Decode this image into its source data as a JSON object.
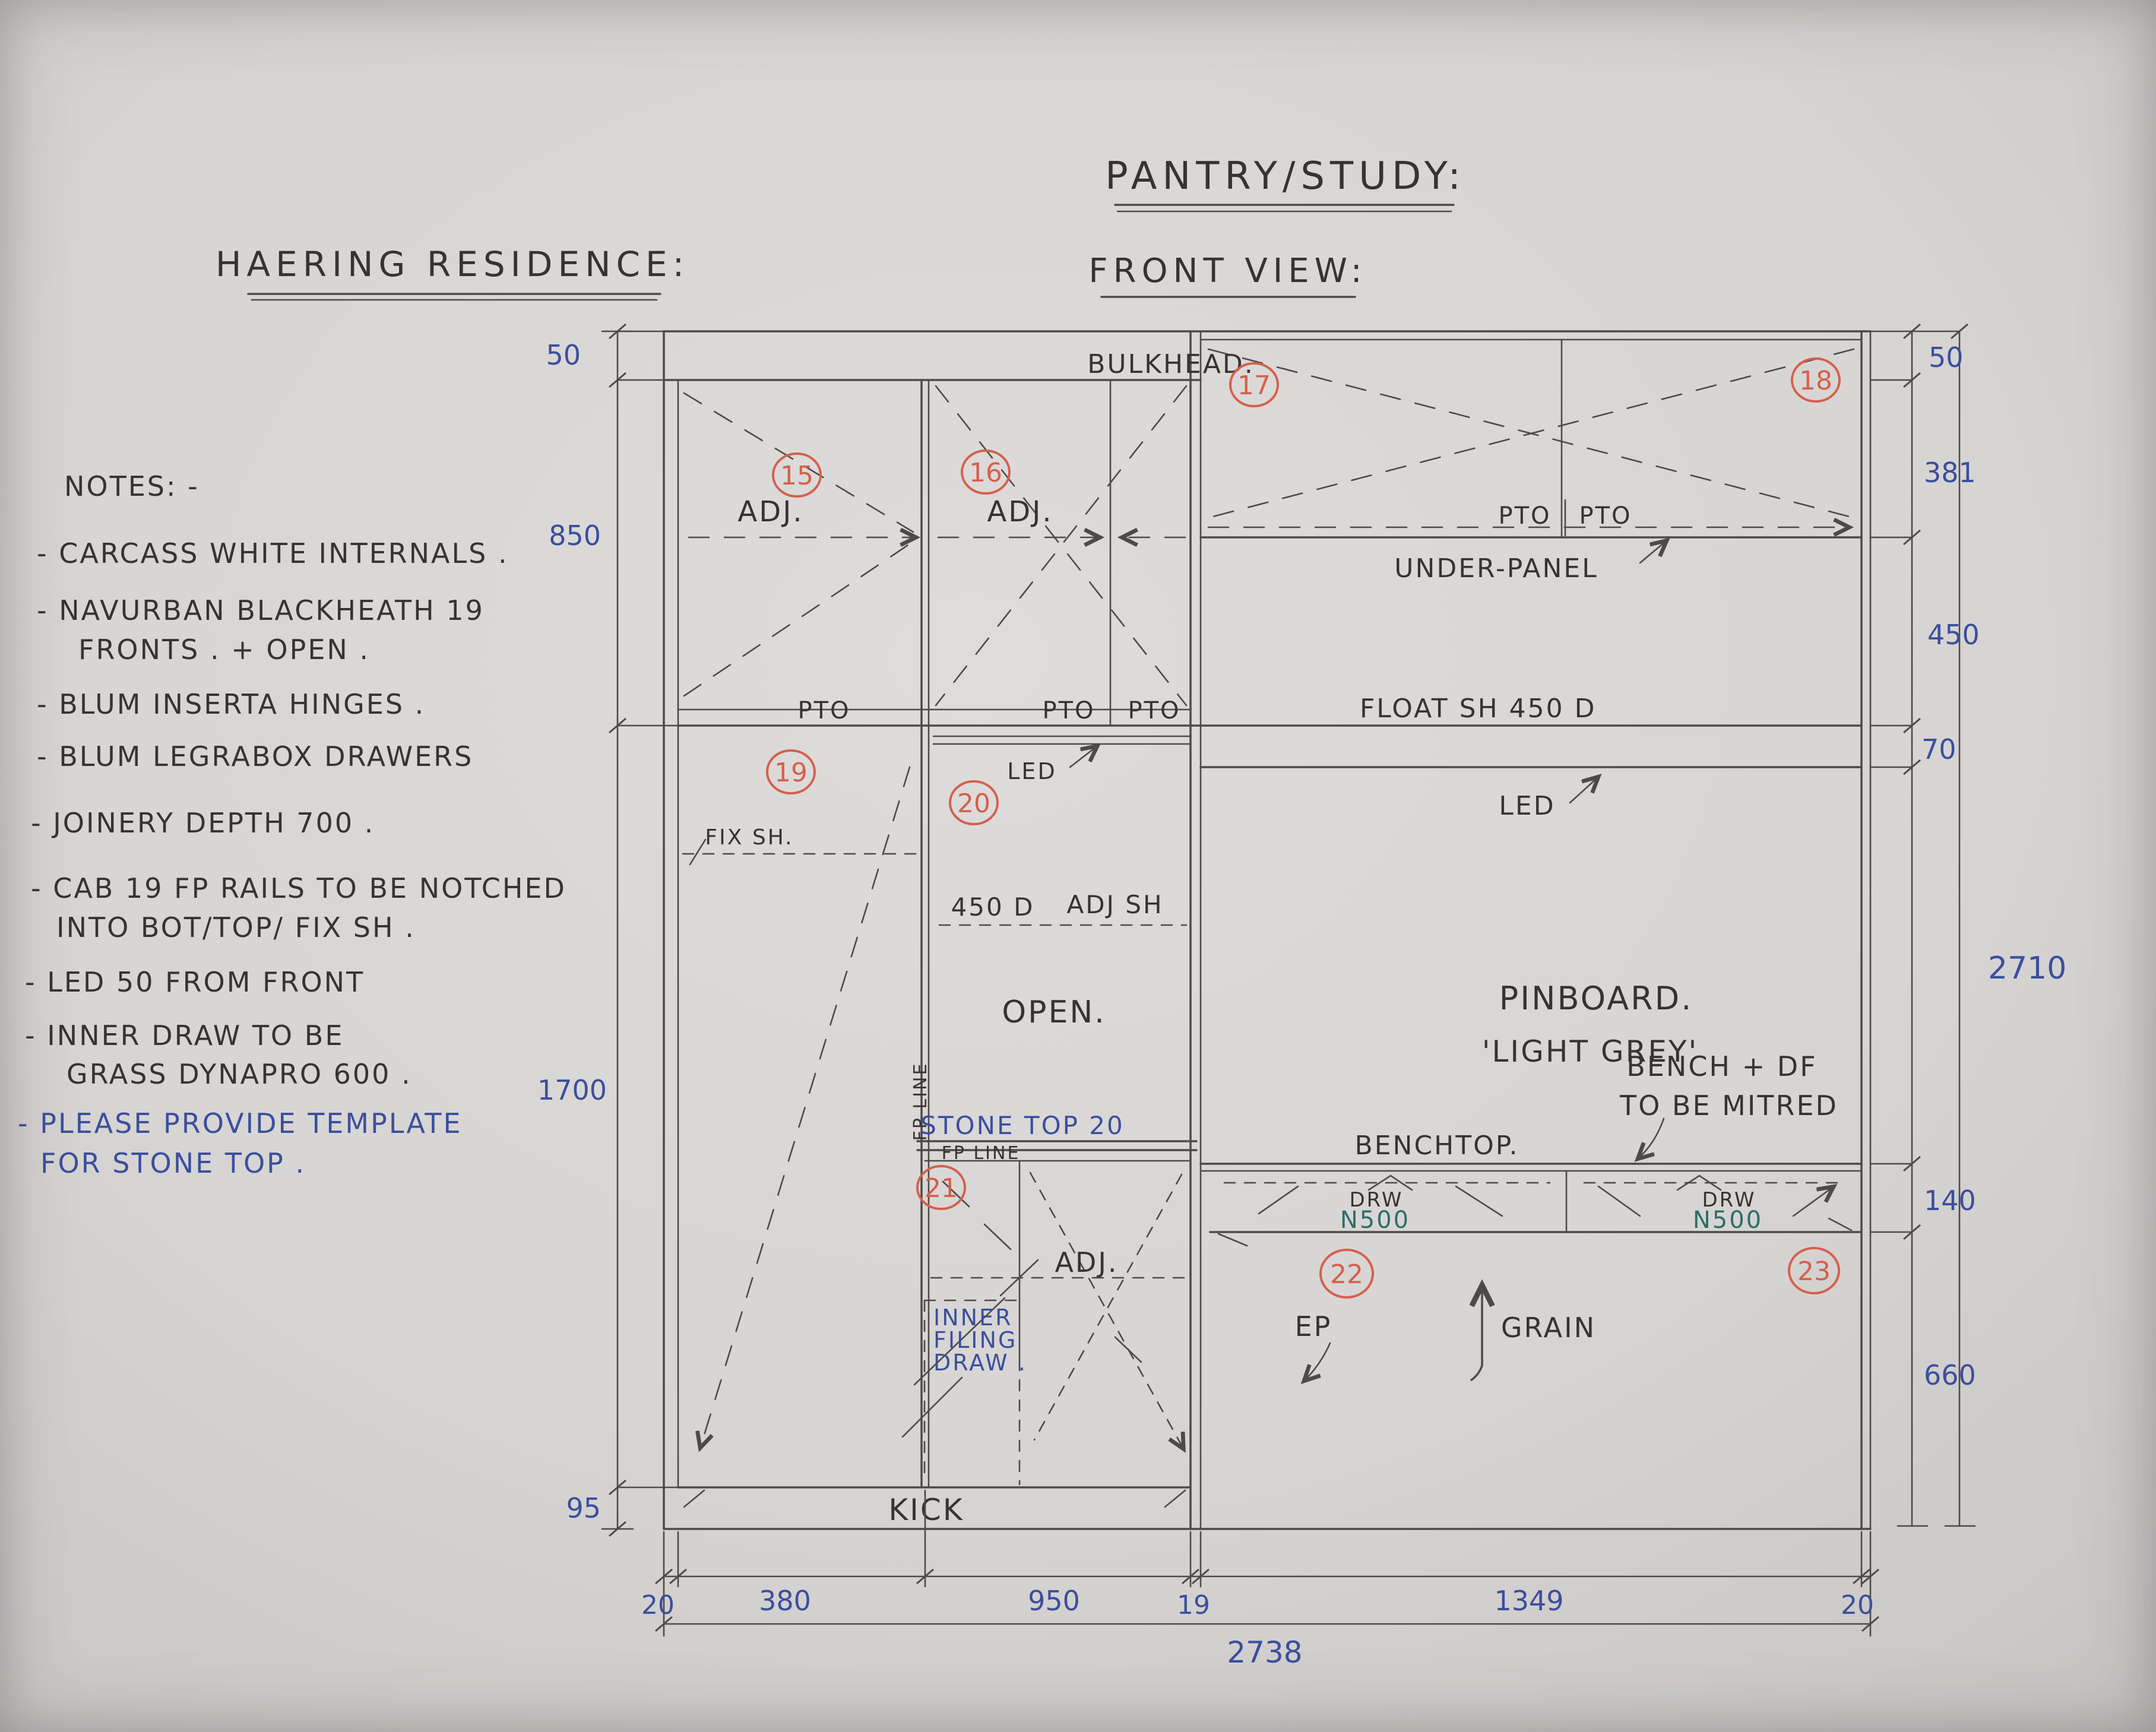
{
  "titles": {
    "residence": "HAERING RESIDENCE:",
    "project": "PANTRY/STUDY:",
    "view": "FRONT VIEW:"
  },
  "notes": {
    "heading": "NOTES: -",
    "lines": [
      {
        "text": "- CARCASS WHITE INTERNALS ."
      },
      {
        "text": "- NAVURBAN BLACKHEATH 19"
      },
      {
        "text": "FRONTS . + OPEN ."
      },
      {
        "text": "- BLUM INSERTA HINGES ."
      },
      {
        "text": "- BLUM LEGRABOX DRAWERS"
      },
      {
        "text": "- JOINERY DEPTH 700 ."
      },
      {
        "text": "- CAB 19 FP RAILS TO BE NOTCHED"
      },
      {
        "text": "INTO BOT/TOP/ FIX SH ."
      },
      {
        "text": "- LED 50 FROM FRONT"
      },
      {
        "text": "- INNER DRAW TO BE"
      },
      {
        "text": "GRASS DYNAPRO 600 ."
      },
      {
        "text": "- PLEASE PROVIDE TEMPLATE",
        "color": "blue"
      },
      {
        "text": "FOR STONE TOP .",
        "color": "blue"
      }
    ]
  },
  "labels": {
    "bulkhead": "BULKHEAD.",
    "adj": "ADJ.",
    "pto": "PTO",
    "under_panel": "UNDER-PANEL",
    "float_shelf": "FLOAT SH 450 D",
    "led": "LED",
    "fix_shelf": "FIX SH.",
    "shelf_depth": "450 D",
    "adj_shelf": "ADJ SH",
    "open": "OPEN.",
    "pinboard": "PINBOARD.",
    "pinboard_colour": "'LIGHT GREY'",
    "stone_top": "STONE TOP 20",
    "fp_line": "FP LINE",
    "benchtop": "BENCHTOP.",
    "bench_note_1": "BENCH + DF",
    "bench_note_2": "TO BE MITRED",
    "drw": "DRW",
    "drawer_model": "N500",
    "ep": "EP",
    "grain": "GRAIN",
    "inner_1": "INNER",
    "inner_2": "FILING",
    "inner_3": "DRAW .",
    "kick": "KICK"
  },
  "item_numbers": [
    "15",
    "16",
    "17",
    "18",
    "19",
    "20",
    "21",
    "22",
    "23"
  ],
  "dimensions": {
    "left": [
      "50",
      "850",
      "1700",
      "95"
    ],
    "right": [
      "50",
      "381",
      "450",
      "70",
      "140",
      "660"
    ],
    "right_total": "2710",
    "bottom": [
      "20",
      "380",
      "950",
      "19",
      "1349",
      "20"
    ],
    "bottom_total": "2738"
  },
  "colors": {
    "paper": "#d9d7d5",
    "pencil": "#4d4a48",
    "ink_blue": "#3b4f9e",
    "marker_red": "#d4604d",
    "ink_teal": "#2c6e69"
  }
}
